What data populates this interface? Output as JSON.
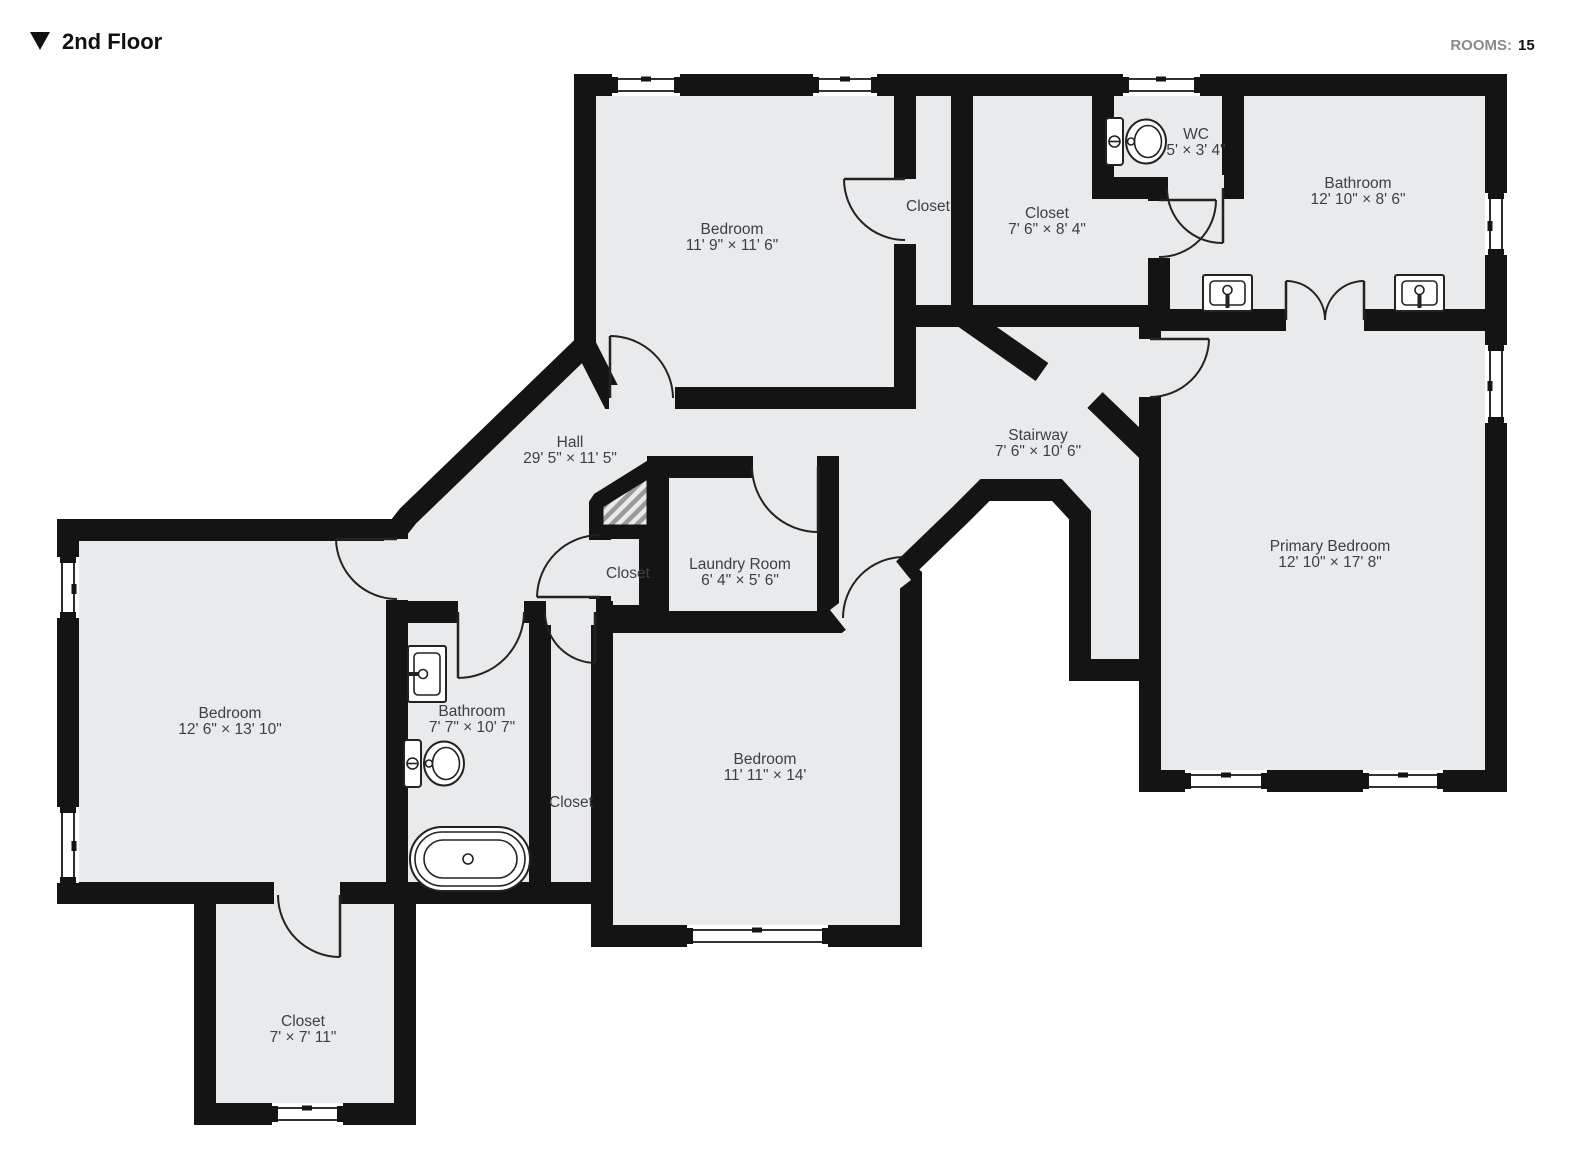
{
  "header": {
    "title": "2nd Floor",
    "collapse_icon": "triangle-down",
    "rooms_label": "ROOMS:",
    "rooms_count": "15"
  },
  "colors": {
    "wall": "#141414",
    "floor": "#E9EAEC",
    "label": "#3C4043",
    "background": "#FFFFFF"
  },
  "rooms": {
    "bedroom_top": {
      "name": "Bedroom",
      "dims": "11' 9\" × 11' 6\""
    },
    "closet_top": {
      "name": "Closet",
      "dims": ""
    },
    "closet_76": {
      "name": "Closet",
      "dims": "7' 6\" × 8' 4\""
    },
    "wc": {
      "name": "WC",
      "dims": "5' × 3' 4\""
    },
    "bathroom_tr": {
      "name": "Bathroom",
      "dims": "12' 10\" × 8' 6\""
    },
    "hall": {
      "name": "Hall",
      "dims": "29' 5\" × 11' 5\""
    },
    "stairway": {
      "name": "Stairway",
      "dims": "7' 6\" × 10' 6\""
    },
    "primary_bedroom": {
      "name": "Primary Bedroom",
      "dims": "12' 10\" × 17' 8\""
    },
    "laundry": {
      "name": "Laundry Room",
      "dims": "6' 4\" × 5' 6\""
    },
    "closet_small": {
      "name": "Closet",
      "dims": ""
    },
    "closet_tall": {
      "name": "Closet",
      "dims": ""
    },
    "bathroom_left": {
      "name": "Bathroom",
      "dims": "7' 7\" × 10' 7\""
    },
    "bedroom_center": {
      "name": "Bedroom",
      "dims": "11' 11\" × 14'"
    },
    "bedroom_left": {
      "name": "Bedroom",
      "dims": "12' 6\" × 13' 10\""
    },
    "closet_bl": {
      "name": "Closet",
      "dims": "7' × 7' 11\""
    }
  },
  "fixtures": [
    "toilet",
    "toilet",
    "sink",
    "sink",
    "sink",
    "bathtub"
  ]
}
